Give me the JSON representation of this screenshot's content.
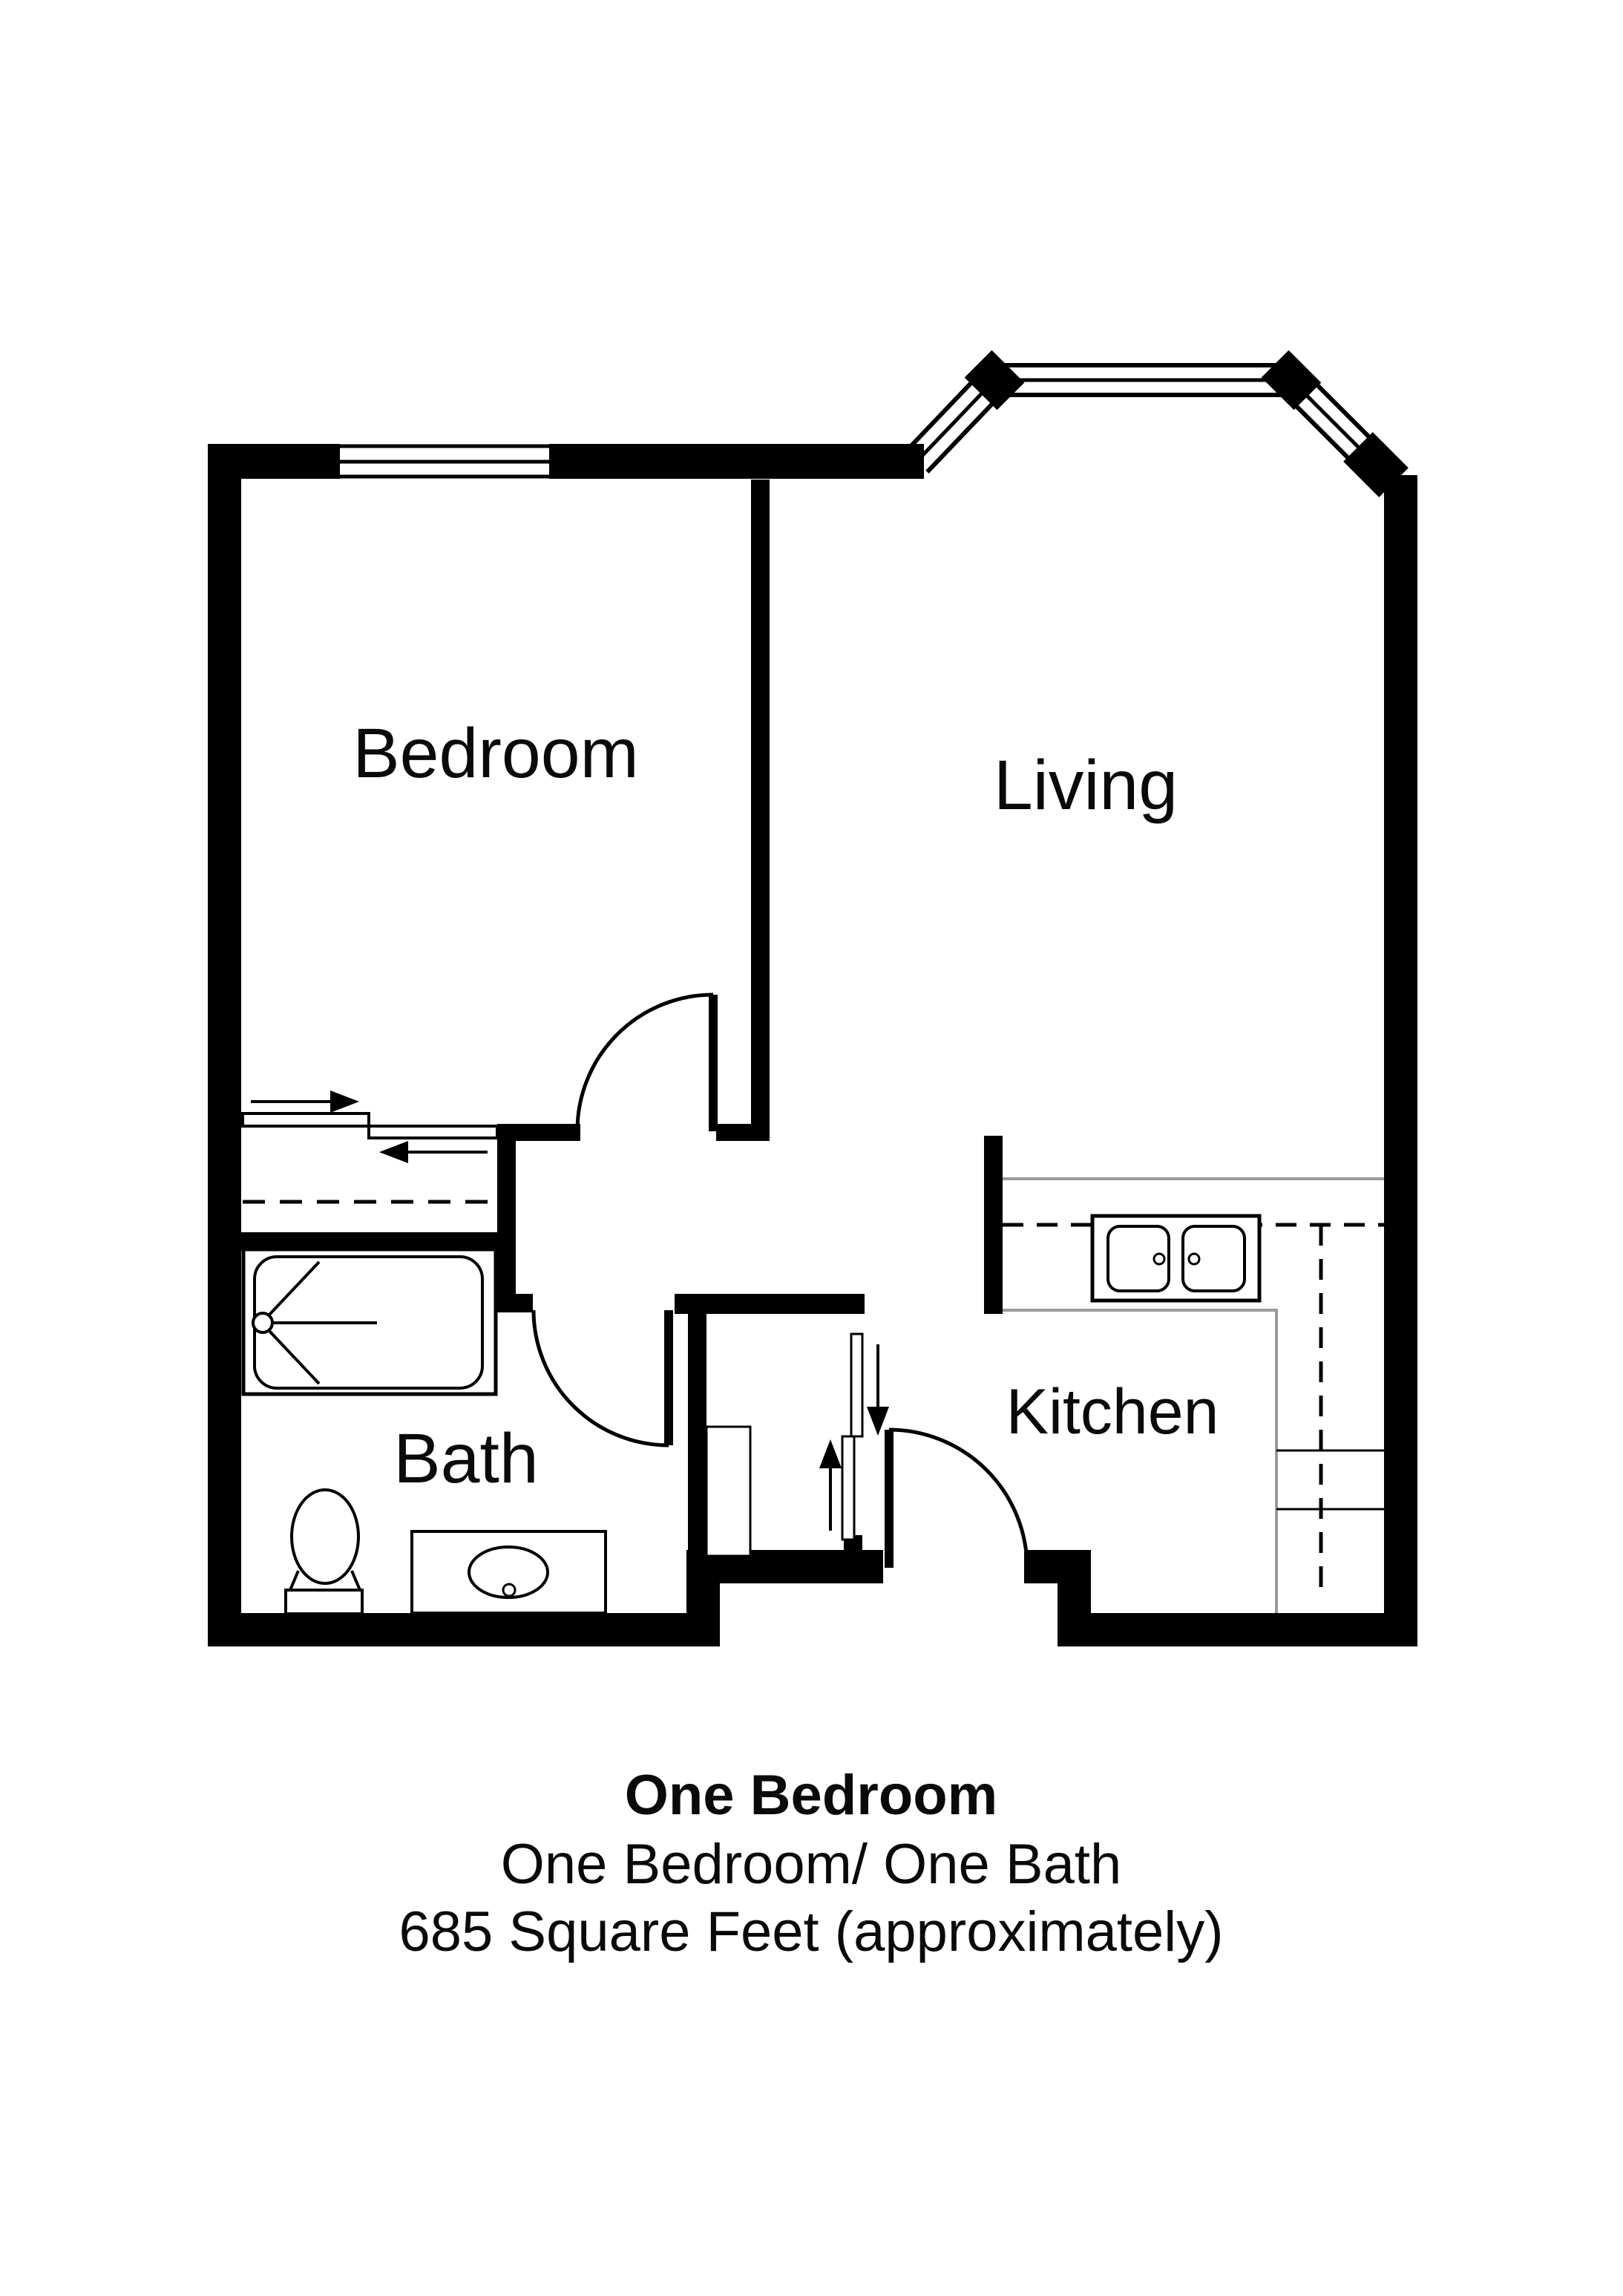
{
  "document_type": "apartment floor plan",
  "rooms": {
    "bedroom": "Bedroom",
    "living": "Living",
    "kitchen": "Kitchen",
    "bath": "Bath"
  },
  "caption": {
    "title": "One Bedroom",
    "subtitle": "One Bedroom/ One Bath",
    "area": "685 Square Feet (approximately)"
  },
  "colors": {
    "walls": "#000000",
    "counter_lines": "#9a9a9a",
    "background": "#ffffff",
    "text": "#0a0a0a"
  },
  "icons": [
    "window-icon",
    "bay-window-icon",
    "door-swing-icon",
    "sliding-door-arrow-icon",
    "bathtub-shower-icon",
    "toilet-icon",
    "vanity-sink-icon",
    "double-kitchen-sink-icon",
    "closet-shelf-icon",
    "dashed-cabinet-line-icon"
  ]
}
